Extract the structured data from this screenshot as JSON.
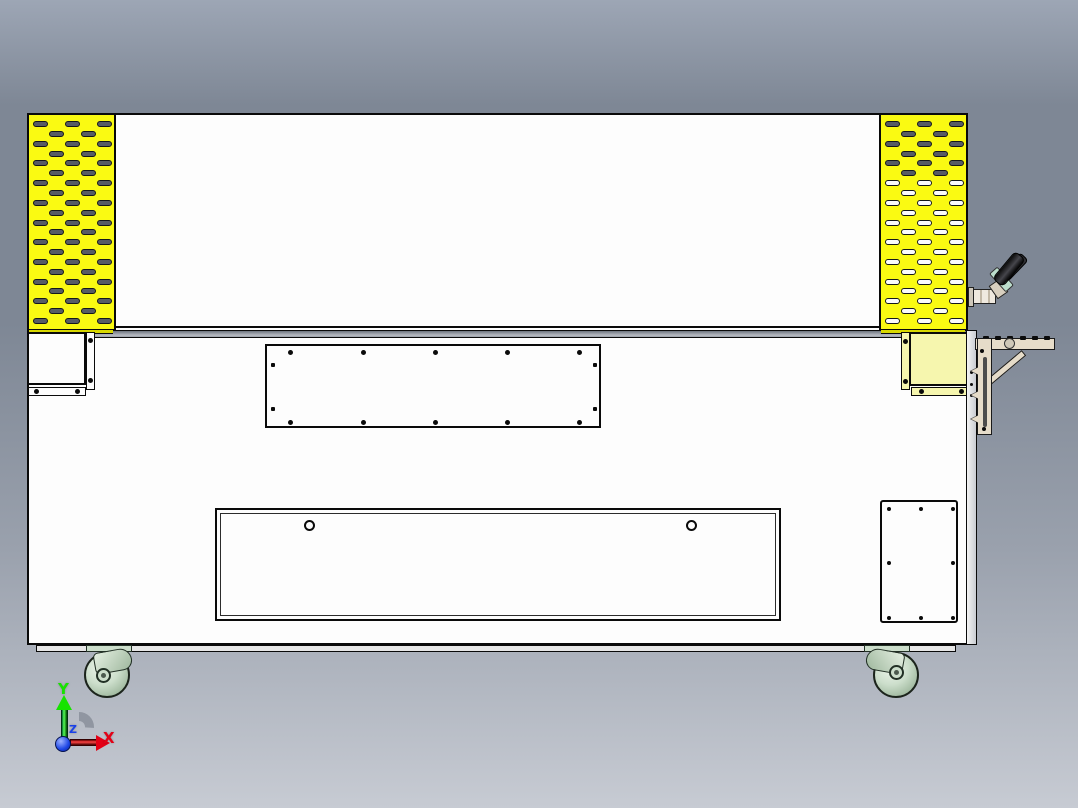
{
  "scene": {
    "description": "Orthographic CAD viewport showing the rear elevation of a machine cabinet with yellow vent panels, access panels and casters"
  },
  "colors": {
    "bg_top": "#9DA6B5",
    "bg_mid": "#7E8795",
    "bg_low": "#9AA1AD",
    "bg_bottom": "#C7CBD3",
    "body_fill": "#FDFDFD",
    "outline": "#0A0A0A",
    "vent_yellow": "#FAFA12",
    "vent_yellow_deep": "#D8D800",
    "pale_yellow": "#F6F6AE",
    "slot_dark": "#575C64",
    "slot_light": "#FBFBFB",
    "slot_outline": "#14171B",
    "divider_a": "#6C737E",
    "divider_b": "#B6BAC1",
    "caster_fill": "#CCDECB",
    "caster_dark": "#9FB89E",
    "bracket_fill": "#E6DCC9",
    "handle_teal": "#BCDECC",
    "screw": "#0B0B0B",
    "axis_x": "#E30016",
    "axis_y": "#17E300",
    "axis_z": "#1A41E8"
  },
  "vents": {
    "slot_rows": 21,
    "left_dark_rows": 21,
    "right_dark_rows": 6,
    "row_a_slots": 3,
    "row_b_slots": 2
  },
  "counts": {
    "top_access_screws": 14,
    "side_access_screws": 8,
    "bottom_door_holes": 2,
    "bracket_arm_bolts": 6
  },
  "axis_triad": {
    "x_label": "X",
    "y_label": "Y",
    "z_label": "Z"
  }
}
